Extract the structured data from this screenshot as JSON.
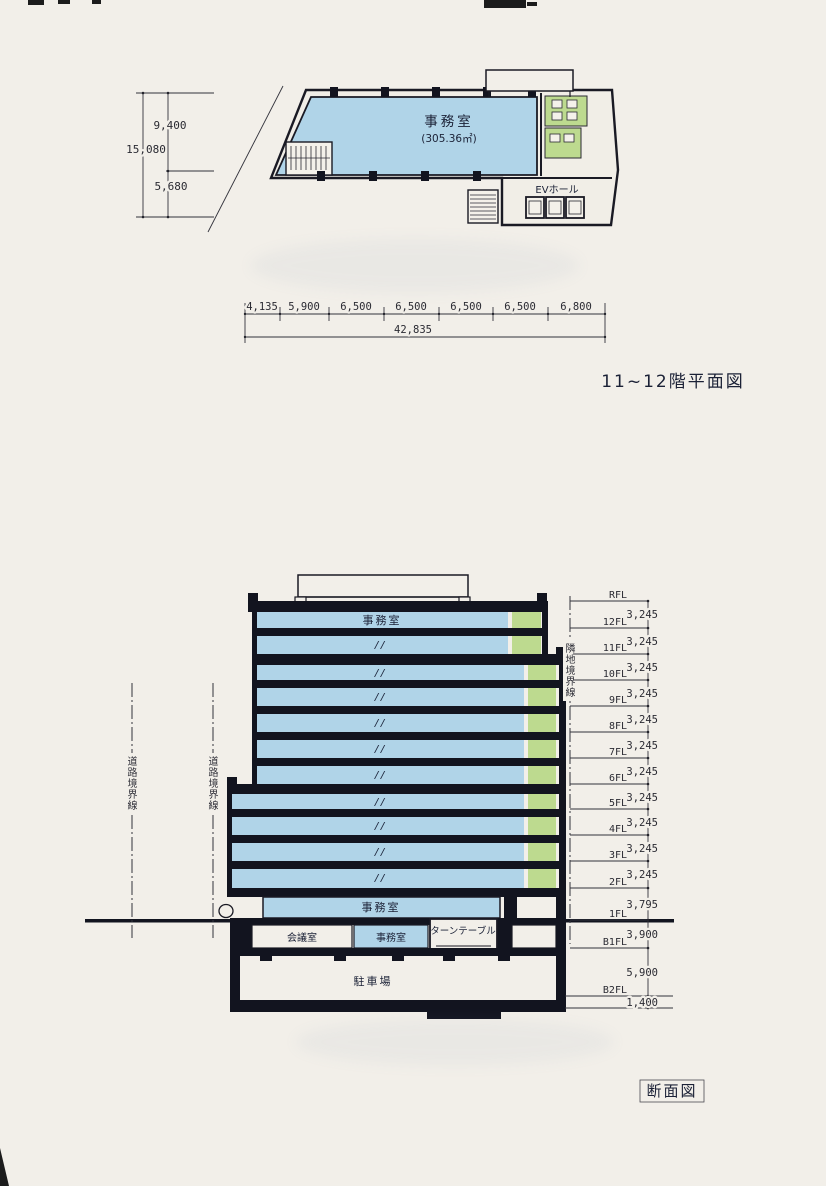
{
  "plan": {
    "title": "11~12階平面図",
    "office_label": "事務室",
    "office_area": "(305.36㎡)",
    "ev_hall_label": "EVホール",
    "dim_left": {
      "total": "15,080",
      "upper": "9,400",
      "lower": "5,680"
    },
    "dim_bottom": {
      "segments": [
        "4,135",
        "5,900",
        "6,500",
        "6,500",
        "6,500",
        "6,500",
        "6,800"
      ],
      "total": "42,835"
    }
  },
  "section": {
    "title": "断面図",
    "office_top": "事務室",
    "ditto": "//",
    "office_1f": "事務室",
    "meeting_room": "会議室",
    "office_b1": "事務室",
    "turntable": "ターンテーブル",
    "parking": "駐車場",
    "road_boundary": "道路境界線",
    "adjacent_boundary": "隣地境界線",
    "levels": [
      {
        "label": "RFL",
        "dim": "3,245"
      },
      {
        "label": "12FL",
        "dim": "3,245"
      },
      {
        "label": "11FL",
        "dim": "3,245"
      },
      {
        "label": "10FL",
        "dim": "3,245"
      },
      {
        "label": "9FL",
        "dim": "3,245"
      },
      {
        "label": "8FL",
        "dim": "3,245"
      },
      {
        "label": "7FL",
        "dim": "3,245"
      },
      {
        "label": "6FL",
        "dim": "3,245"
      },
      {
        "label": "5FL",
        "dim": "3,245"
      },
      {
        "label": "4FL",
        "dim": "3,245"
      },
      {
        "label": "3FL",
        "dim": "3,245"
      },
      {
        "label": "2FL",
        "dim": "3,795"
      },
      {
        "label": "1FL",
        "dim": "3,900"
      },
      {
        "label": "B1FL",
        "dim": "5,900"
      },
      {
        "label": "B2FL",
        "dim": "1,400"
      }
    ]
  },
  "colors": {
    "paper": "#f2efe9",
    "floor_blue": "#b0d4e8",
    "room_green": "#bdda8f",
    "ink": "#12141f"
  }
}
